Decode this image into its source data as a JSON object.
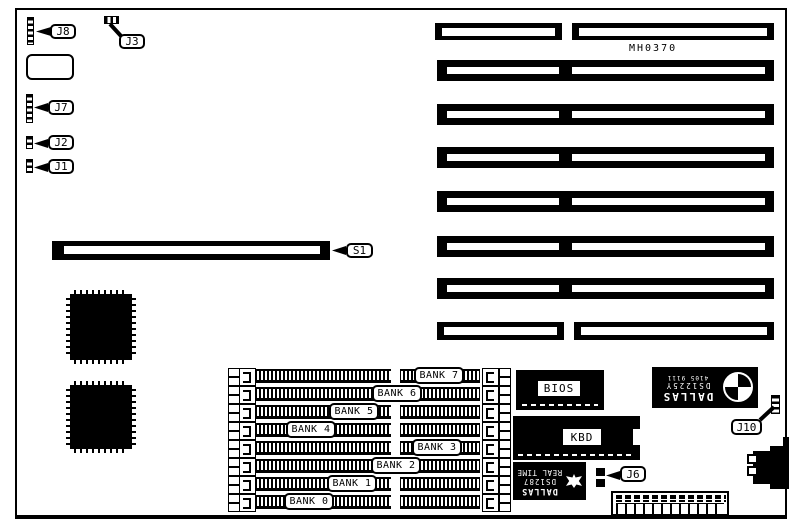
{
  "board": {
    "marking": "MH0370"
  },
  "callouts": {
    "j1": "J1",
    "j2": "J2",
    "j3": "J3",
    "j6": "J6",
    "j7": "J7",
    "j8": "J8",
    "j10": "J10",
    "s1": "S1"
  },
  "memory_banks": {
    "labels": [
      "BANK 7",
      "BANK 6",
      "BANK 5",
      "BANK 4",
      "BANK 3",
      "BANK 2",
      "BANK 1",
      "BANK 0"
    ]
  },
  "chips": {
    "bios": "BIOS",
    "kbd": "KBD",
    "nvram_brand": "DALLAS",
    "nvram_part": "DS1225Y",
    "nvram_code": "4105 9111",
    "rtc_brand": "DALLAS",
    "rtc_part": "DS1287",
    "rtc_type": "REAL TIME"
  },
  "colors": {
    "ink": "#000000",
    "paper": "#ffffff"
  }
}
